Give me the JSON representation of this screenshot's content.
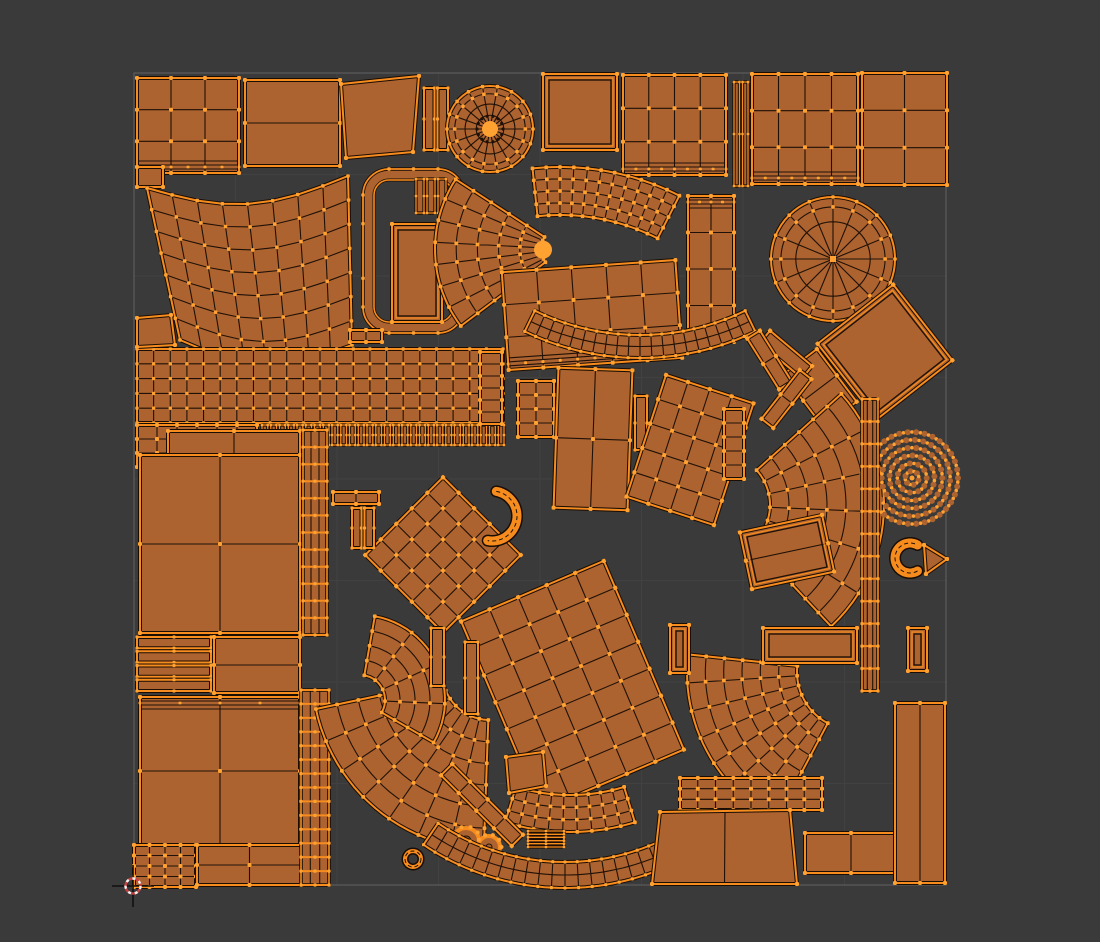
{
  "viewport": {
    "width": 1100,
    "height": 942
  },
  "colors": {
    "background": "#3a3a3a",
    "island_fill": "#ad6330",
    "wireframe": "#1f1107",
    "selected_edge": "#f78c1e",
    "selected_vertex": "#ffa232",
    "edge_rim": "#190d04",
    "uv_border": "#8a8a8a",
    "uv_grid": "#9a9a9a",
    "cursor_red": "#c84040",
    "cursor_white": "#f0f0f0",
    "cursor_cross": "#101010"
  },
  "uv_square": {
    "x": 134,
    "y": 73,
    "size": 812,
    "grid_divisions": 8
  },
  "cursor_2d": {
    "x": 133,
    "y": 886
  },
  "islands": [
    {
      "t": "grid",
      "x": 137,
      "y": 78,
      "w": 102,
      "h": 95,
      "cols": 3,
      "rows": 3,
      "dense": "bottom"
    },
    {
      "t": "grid",
      "x": 245,
      "y": 80,
      "w": 95,
      "h": 86,
      "cols": 1,
      "rows": 2
    },
    {
      "t": "poly",
      "pts": [
        [
          341,
          84
        ],
        [
          419,
          76
        ],
        [
          413,
          152
        ],
        [
          346,
          158
        ]
      ]
    },
    {
      "t": "bars",
      "x": 424,
      "y": 88,
      "w": 24,
      "h": 62,
      "n": 2,
      "dir": "v"
    },
    {
      "t": "disc",
      "cx": 490,
      "cy": 129,
      "r": 43,
      "spokes": 18,
      "ringR": [
        0.32,
        0.58,
        0.82
      ],
      "spokeInner": 0.14,
      "hub": true
    },
    {
      "t": "grid",
      "x": 543,
      "y": 74,
      "w": 74,
      "h": 76,
      "cols": 1,
      "rows": 1,
      "inset": true
    },
    {
      "t": "grid",
      "x": 623,
      "y": 75,
      "w": 103,
      "h": 100,
      "cols": 4,
      "rows": 3,
      "dense": "bottom"
    },
    {
      "t": "bars",
      "x": 734,
      "y": 82,
      "w": 14,
      "h": 104,
      "n": 2,
      "dir": "v"
    },
    {
      "t": "grid",
      "x": 752,
      "y": 74,
      "w": 106,
      "h": 110,
      "cols": 4,
      "rows": 3,
      "dense": "bottom"
    },
    {
      "t": "grid",
      "x": 862,
      "y": 73,
      "w": 85,
      "h": 112,
      "cols": 2,
      "rows": 3
    },
    {
      "t": "grid",
      "x": 137,
      "y": 167,
      "w": 26,
      "h": 20,
      "cols": 1,
      "rows": 1
    },
    {
      "t": "warp",
      "c": [
        [
          147,
          188
        ],
        [
          348,
          176
        ],
        [
          352,
          345
        ],
        [
          180,
          340
        ]
      ],
      "cols": 8,
      "rows": 7,
      "bulge": 22
    },
    {
      "t": "loop",
      "x": 363,
      "y": 169,
      "w": 101,
      "h": 164,
      "rx": 26,
      "band": 11
    },
    {
      "t": "bars",
      "x": 416,
      "y": 179,
      "w": 30,
      "h": 34,
      "n": 3,
      "dir": "v"
    },
    {
      "t": "grid",
      "x": 392,
      "y": 224,
      "w": 50,
      "h": 98,
      "cols": 1,
      "rows": 1,
      "inset": true
    },
    {
      "t": "arc",
      "cx": 563,
      "cy": 249,
      "r0": 22,
      "r1": 128,
      "a0": 143,
      "a1": 213,
      "segs": 7,
      "rows": 5,
      "tip": true
    },
    {
      "t": "arc",
      "cx": 560,
      "cy": 430,
      "r0": 215,
      "r1": 263,
      "a0": 264,
      "a1": 297,
      "segs": 11,
      "rows": 4
    },
    {
      "t": "disc",
      "cx": 833,
      "cy": 259,
      "r": 62,
      "spokes": 16,
      "ringR": [
        0.6,
        0.84
      ],
      "spokeInner": 0,
      "hub": false
    },
    {
      "t": "grid",
      "x": 837,
      "y": 304,
      "w": 96,
      "h": 96,
      "rot": -38,
      "cols": 1,
      "rows": 1,
      "inset": true
    },
    {
      "t": "grid",
      "x": 799,
      "y": 355,
      "w": 42,
      "h": 66,
      "rot": -37,
      "cols": 1,
      "rows": 2
    },
    {
      "t": "grid",
      "x": 778,
      "y": 327,
      "w": 16,
      "h": 55,
      "rot": -50,
      "cols": 1,
      "rows": 1
    },
    {
      "t": "grid",
      "x": 137,
      "y": 349,
      "w": 366,
      "h": 74,
      "cols": 22,
      "rows": 5
    },
    {
      "t": "bars",
      "x": 262,
      "y": 425,
      "w": 242,
      "h": 20,
      "n": 28,
      "dir": "v"
    },
    {
      "t": "grid",
      "x": 137,
      "y": 425,
      "w": 120,
      "h": 42,
      "cols": 6,
      "rows": 3
    },
    {
      "t": "grid",
      "x": 350,
      "y": 330,
      "w": 32,
      "h": 12,
      "cols": 2,
      "rows": 1
    },
    {
      "t": "poly",
      "pts": [
        [
          137,
          318
        ],
        [
          171,
          315
        ],
        [
          175,
          345
        ],
        [
          137,
          347
        ]
      ]
    },
    {
      "t": "grid",
      "x": 505,
      "y": 266,
      "w": 174,
      "h": 98,
      "rot": -4,
      "cols": 5,
      "rows": 3,
      "dense": "bottom"
    },
    {
      "t": "grid",
      "x": 688,
      "y": 196,
      "w": 46,
      "h": 146,
      "cols": 2,
      "rows": 4,
      "dense": "top"
    },
    {
      "t": "arc",
      "cx": 640,
      "cy": 95,
      "r0": 240,
      "r1": 263,
      "a0": 64,
      "a1": 116,
      "segs": 20,
      "rows": 2
    },
    {
      "t": "grid",
      "x": 480,
      "y": 352,
      "w": 22,
      "h": 72,
      "cols": 1,
      "rows": 6
    },
    {
      "t": "grid",
      "x": 518,
      "y": 381,
      "w": 36,
      "h": 56,
      "cols": 2,
      "rows": 4
    },
    {
      "t": "grid",
      "x": 556,
      "y": 369,
      "w": 74,
      "h": 140,
      "rot": 2,
      "cols": 2,
      "rows": 2
    },
    {
      "t": "bars",
      "x": 635,
      "y": 396,
      "w": 12,
      "h": 54,
      "n": 1,
      "dir": "v"
    },
    {
      "t": "grid",
      "x": 644,
      "y": 386,
      "w": 92,
      "h": 128,
      "rot": 18,
      "cols": 4,
      "rows": 5
    },
    {
      "t": "grid",
      "x": 724,
      "y": 409,
      "w": 20,
      "h": 70,
      "cols": 1,
      "rows": 5
    },
    {
      "t": "grid",
      "x": 762,
      "y": 330,
      "w": 15,
      "h": 60,
      "rot": -32,
      "cols": 1,
      "rows": 2
    },
    {
      "t": "grid",
      "x": 779,
      "y": 368,
      "w": 15,
      "h": 62,
      "rot": 38,
      "cols": 1,
      "rows": 2
    },
    {
      "t": "arc",
      "cx": 718,
      "cy": 505,
      "r0": 52,
      "r1": 166,
      "a0": -42,
      "a1": 47,
      "segs": 6,
      "rows": 6
    },
    {
      "t": "grid",
      "x": 745,
      "y": 523,
      "w": 84,
      "h": 58,
      "rot": -12,
      "cols": 1,
      "rows": 2,
      "inset": true
    },
    {
      "t": "dotdisc",
      "cx": 912,
      "cy": 478,
      "r": 47
    },
    {
      "t": "ring",
      "cx": 910,
      "cy": 558,
      "r": 15,
      "a0": 60,
      "a1": 300,
      "w": 9
    },
    {
      "t": "poly",
      "pts": [
        [
          924,
          545
        ],
        [
          947,
          559
        ],
        [
          926,
          574
        ]
      ]
    },
    {
      "t": "rope",
      "x": 862,
      "y": 399,
      "w": 16,
      "h": 292,
      "rungs": 13
    },
    {
      "t": "grid",
      "x": 168,
      "y": 431,
      "w": 132,
      "h": 24,
      "cols": 2,
      "rows": 1
    },
    {
      "t": "grid",
      "x": 140,
      "y": 455,
      "w": 160,
      "h": 178,
      "cols": 2,
      "rows": 2
    },
    {
      "t": "bars",
      "x": 137,
      "y": 637,
      "w": 74,
      "h": 54,
      "n": 4,
      "dir": "h"
    },
    {
      "t": "grid",
      "x": 214,
      "y": 637,
      "w": 86,
      "h": 56,
      "cols": 1,
      "rows": 2
    },
    {
      "t": "grid",
      "x": 140,
      "y": 697,
      "w": 160,
      "h": 148,
      "cols": 2,
      "rows": 2,
      "dense": "top"
    },
    {
      "t": "grid",
      "x": 134,
      "y": 845,
      "w": 62,
      "h": 42,
      "cols": 4,
      "rows": 4
    },
    {
      "t": "grid",
      "x": 197,
      "y": 845,
      "w": 105,
      "h": 40,
      "cols": 2,
      "rows": 2
    },
    {
      "t": "rope",
      "x": 301,
      "y": 690,
      "w": 28,
      "h": 195,
      "rungs": 14
    },
    {
      "t": "rope",
      "x": 303,
      "y": 430,
      "w": 24,
      "h": 205,
      "rungs": 12
    },
    {
      "t": "arc",
      "cx": 490,
      "cy": 672,
      "r0": 48,
      "r1": 178,
      "a0": 92,
      "a1": 168,
      "segs": 7,
      "rows": 6
    },
    {
      "t": "grid",
      "x": 388,
      "y": 500,
      "w": 110,
      "h": 110,
      "rot": 45,
      "cols": 5,
      "rows": 5
    },
    {
      "t": "ring",
      "cx": 492,
      "cy": 516,
      "r": 25,
      "a0": -80,
      "a1": 100,
      "w": 9
    },
    {
      "t": "grid",
      "x": 333,
      "y": 492,
      "w": 46,
      "h": 12,
      "cols": 2,
      "rows": 1
    },
    {
      "t": "bars",
      "x": 352,
      "y": 508,
      "w": 22,
      "h": 40,
      "n": 2,
      "dir": "v"
    },
    {
      "t": "arc",
      "cx": 360,
      "cy": 700,
      "r0": 25,
      "r1": 85,
      "a0": -80,
      "a1": 30,
      "segs": 4,
      "rows": 4
    },
    {
      "t": "gear",
      "cx": 466,
      "cy": 841,
      "r": 13
    },
    {
      "t": "gear",
      "cx": 489,
      "cy": 847,
      "r": 11
    },
    {
      "t": "ring",
      "cx": 413,
      "cy": 859,
      "r": 8,
      "a0": 0,
      "a1": 359,
      "w": 4
    },
    {
      "t": "grid",
      "x": 495,
      "y": 583,
      "w": 155,
      "h": 205,
      "rot": -23,
      "cols": 5,
      "rows": 7
    },
    {
      "t": "arc",
      "cx": 570,
      "cy": 610,
      "r0": 185,
      "r1": 222,
      "a0": 73,
      "a1": 107,
      "segs": 9,
      "rows": 3
    },
    {
      "t": "bars",
      "x": 528,
      "y": 831,
      "w": 36,
      "h": 16,
      "n": 3,
      "dir": "h"
    },
    {
      "t": "arc",
      "cx": 565,
      "cy": 635,
      "r0": 227,
      "r1": 253,
      "a0": 56,
      "a1": 124,
      "segs": 22,
      "rows": 2
    },
    {
      "t": "grid",
      "x": 474,
      "y": 755,
      "w": 16,
      "h": 100,
      "rot": -45,
      "cols": 1,
      "rows": 4
    },
    {
      "t": "poly",
      "pts": [
        [
          506,
          757
        ],
        [
          543,
          752
        ],
        [
          546,
          786
        ],
        [
          509,
          793
        ]
      ]
    },
    {
      "t": "bars",
      "x": 431,
      "y": 628,
      "w": 13,
      "h": 58,
      "n": 1,
      "dir": "v"
    },
    {
      "t": "bars",
      "x": 465,
      "y": 642,
      "w": 13,
      "h": 72,
      "n": 1,
      "dir": "v"
    },
    {
      "t": "arc",
      "cx": 855,
      "cy": 672,
      "r0": 58,
      "r1": 168,
      "a0": 118,
      "a1": 186,
      "segs": 7,
      "rows": 6
    },
    {
      "t": "grid",
      "x": 680,
      "y": 778,
      "w": 142,
      "h": 32,
      "cols": 8,
      "rows": 3
    },
    {
      "t": "poly",
      "pts": [
        [
          660,
          812
        ],
        [
          790,
          810
        ],
        [
          797,
          884
        ],
        [
          652,
          884
        ]
      ],
      "mid": true
    },
    {
      "t": "grid",
      "x": 805,
      "y": 833,
      "w": 92,
      "h": 40,
      "cols": 2,
      "rows": 1
    },
    {
      "t": "grid",
      "x": 895,
      "y": 703,
      "w": 50,
      "h": 180,
      "cols": 2,
      "rows": 1
    },
    {
      "t": "grid",
      "x": 763,
      "y": 628,
      "w": 94,
      "h": 35,
      "cols": 1,
      "rows": 1,
      "inset": true
    },
    {
      "t": "grid",
      "x": 670,
      "y": 625,
      "w": 19,
      "h": 48,
      "cols": 1,
      "rows": 1,
      "inset": true
    },
    {
      "t": "grid",
      "x": 908,
      "y": 628,
      "w": 19,
      "h": 43,
      "cols": 1,
      "rows": 1,
      "inset": true
    }
  ]
}
